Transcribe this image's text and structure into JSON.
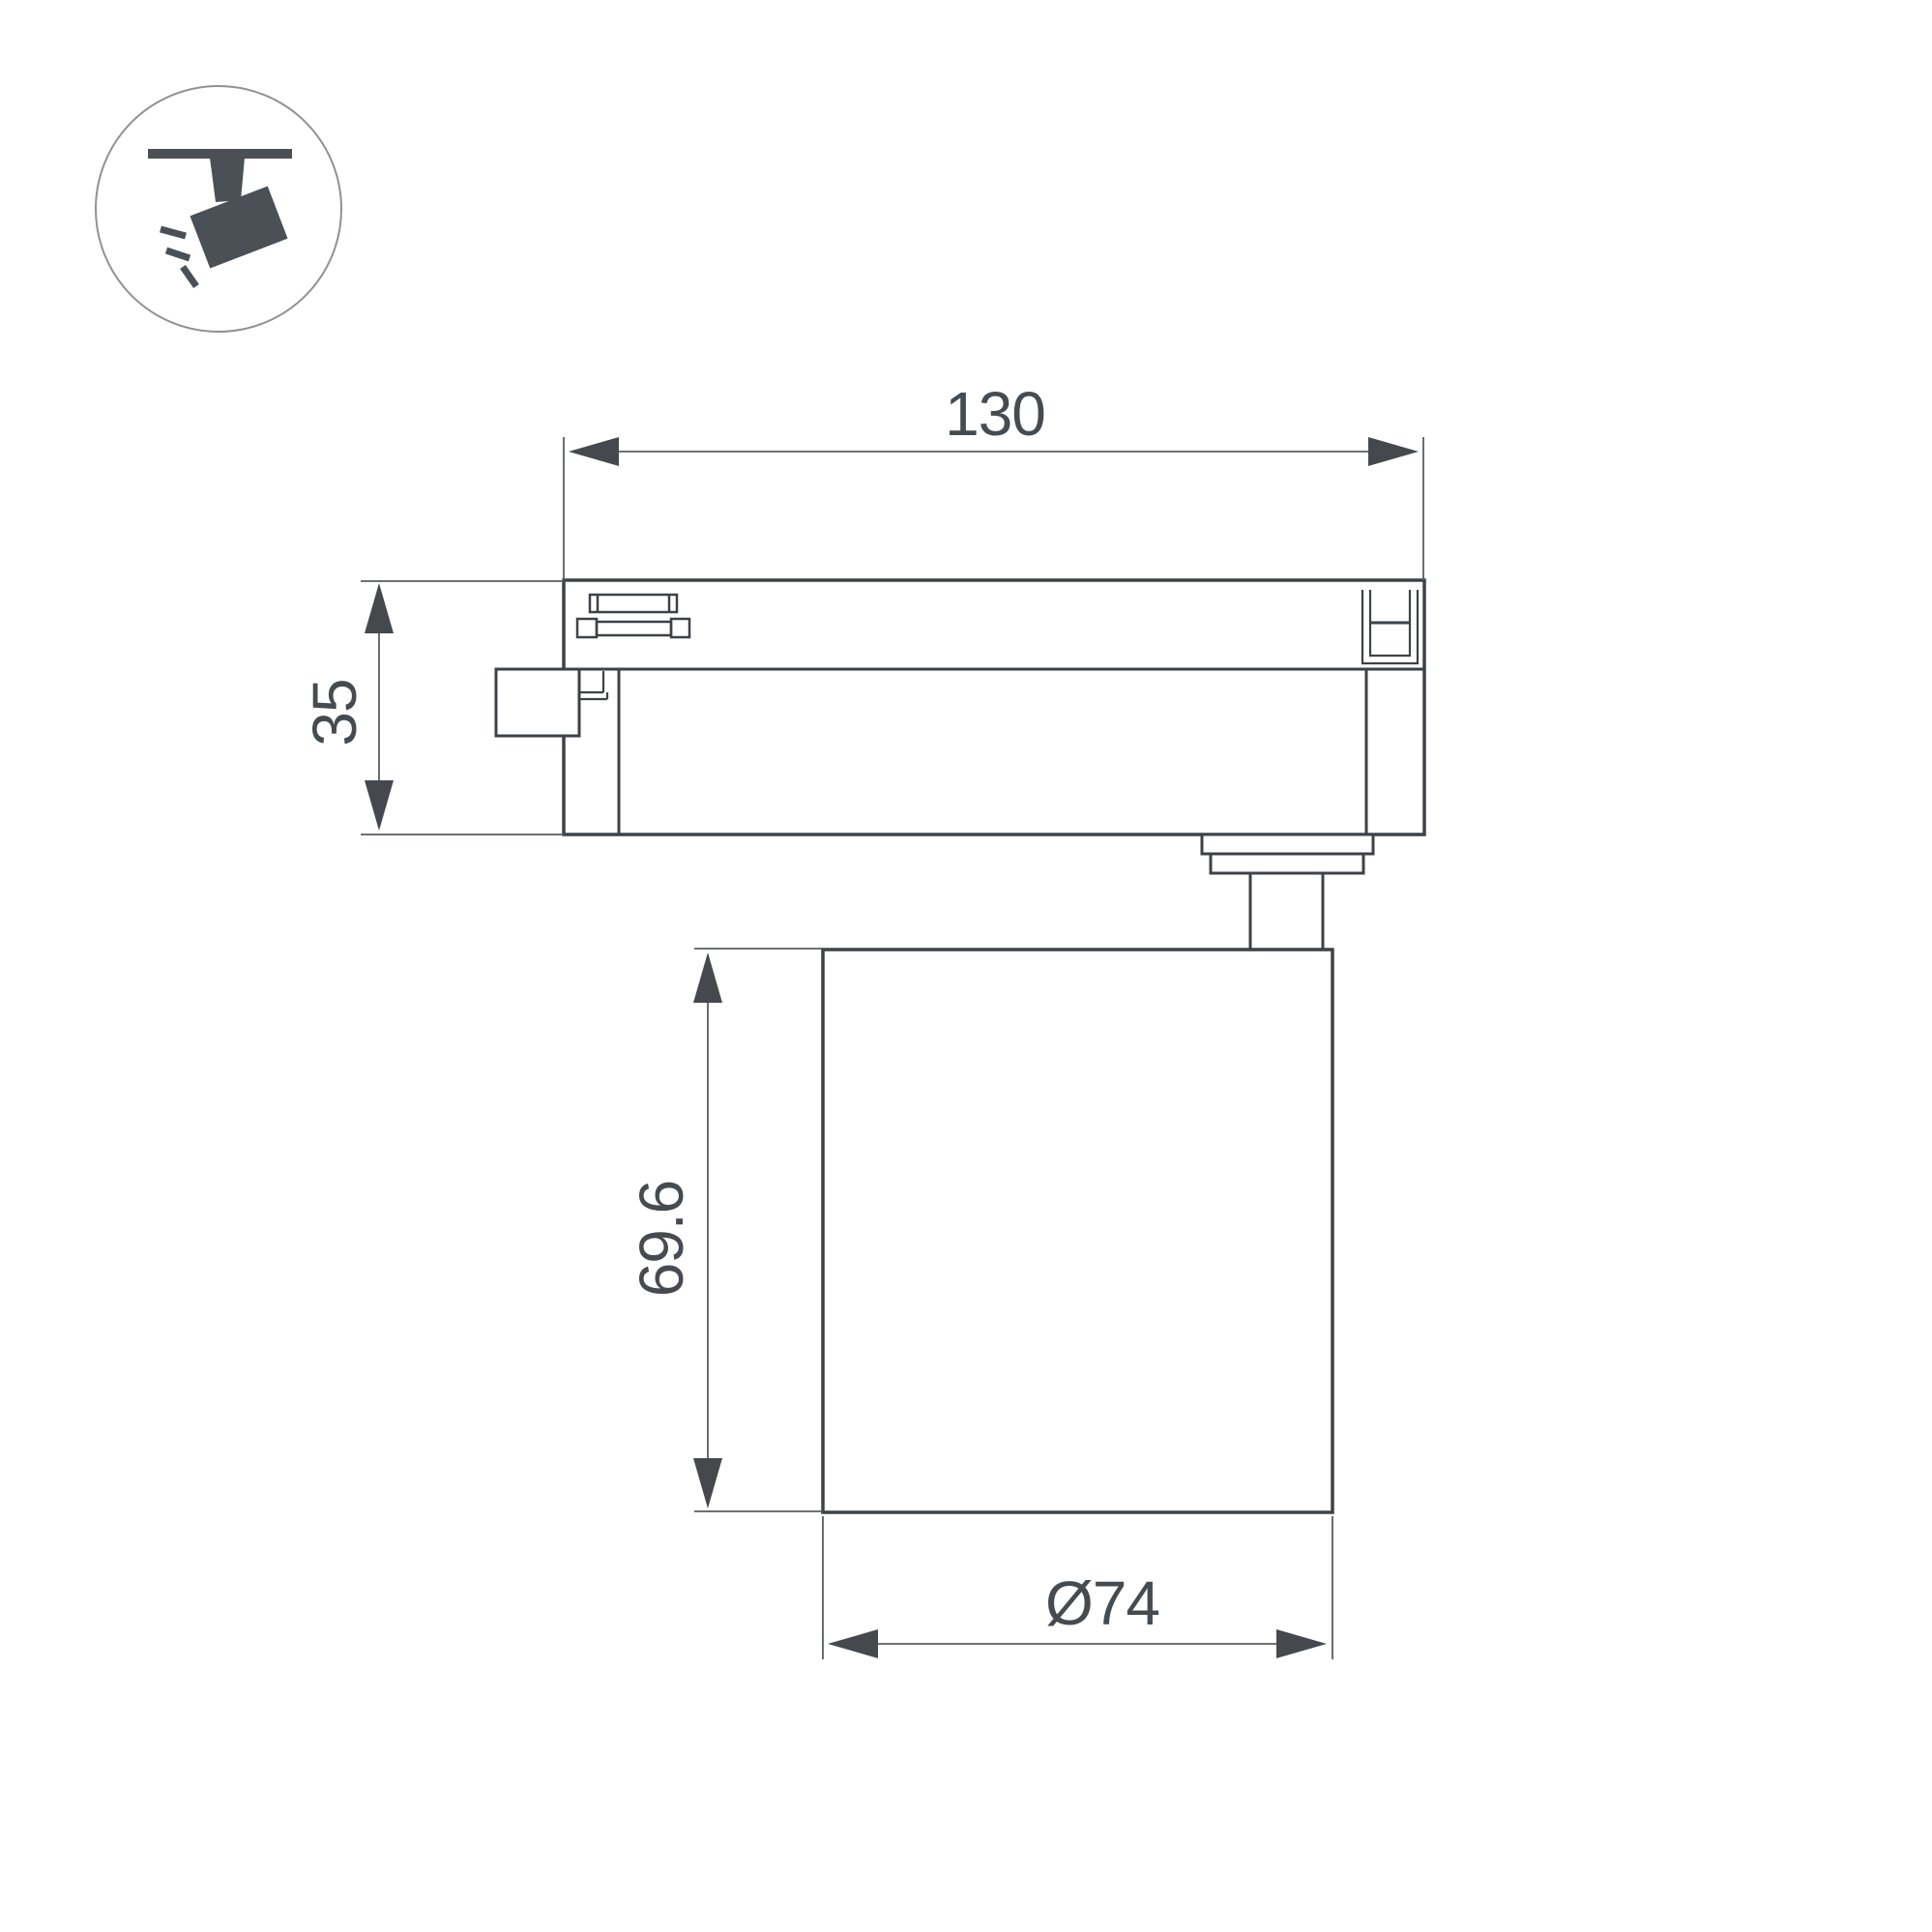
{
  "drawing": {
    "type": "technical-dimension-drawing",
    "subject": "track-mounted spotlight luminaire side view",
    "dimensions": {
      "track_width": {
        "label": "130"
      },
      "adapter_height": {
        "label": "35"
      },
      "lamp_height": {
        "label": "69.6"
      },
      "lamp_diameter": {
        "label": "Ø74"
      }
    },
    "icon": {
      "name": "track-spotlight-icon"
    },
    "colors": {
      "background": "#ffffff",
      "outline": "#3d4247",
      "dim_line": "#595d61",
      "text": "#464b50",
      "icon_fill": "#4a5056",
      "icon_circle_stroke": "#8f9294"
    }
  }
}
